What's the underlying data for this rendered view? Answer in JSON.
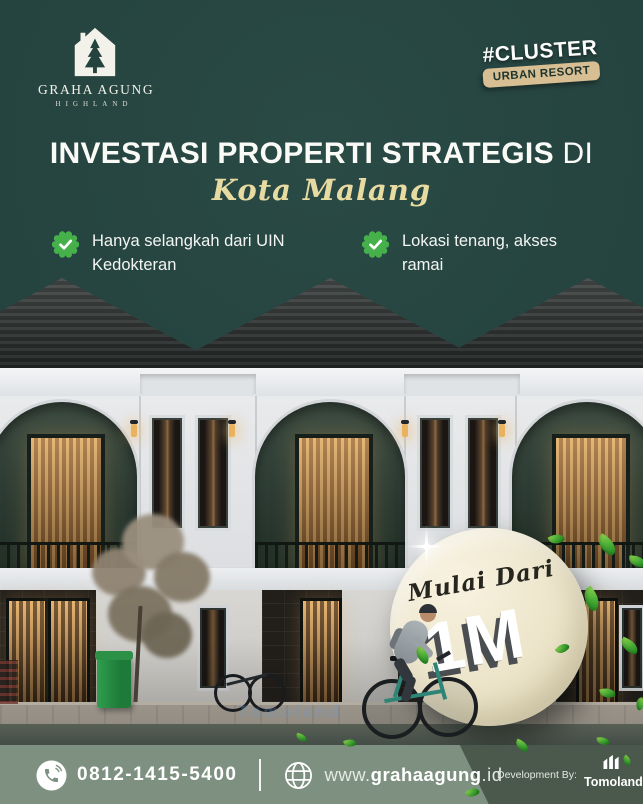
{
  "colors": {
    "background": "#24423E",
    "accent_green": "#46B14B",
    "headline_white": "#FAFAF7",
    "script_cream": "#E8DBA2",
    "badge_tan": "#D8BE93",
    "price_circle_cream": "#EBE3C9",
    "footer_sage": "#7E9181",
    "footer_dark": "#4A594C"
  },
  "brand": {
    "name": "GRAHA AGUNG",
    "tagline": "HIGHLAND"
  },
  "cluster_badge": {
    "hashtag": "#CLUSTER",
    "label": "URBAN RESORT"
  },
  "headline": {
    "bold": "INVESTASI PROPERTI STRATEGIS",
    "regular": "DI",
    "script": "Kota Malang"
  },
  "features": [
    {
      "text": "Hanya selangkah dari UIN Kedokteran"
    },
    {
      "text": "Lokasi tenang, akses ramai"
    }
  ],
  "price_badge": {
    "prefix": "Mulai Dari",
    "value": "1M"
  },
  "watermark": "Tomoland",
  "footer": {
    "phone": "0812-1415-5400",
    "website": {
      "prefix": "www.",
      "bold": "grahaagung",
      "suffix": ".id"
    },
    "development_by": "Development By:",
    "developer": "Tomoland"
  },
  "icons": {
    "logo": "house-pine-icon",
    "feature": "check-badge-icon",
    "phone": "phone-icon",
    "website": "globe-icon",
    "price": "sparkle-icon",
    "decoration": "leaf-icon",
    "developer": "building-icon"
  }
}
